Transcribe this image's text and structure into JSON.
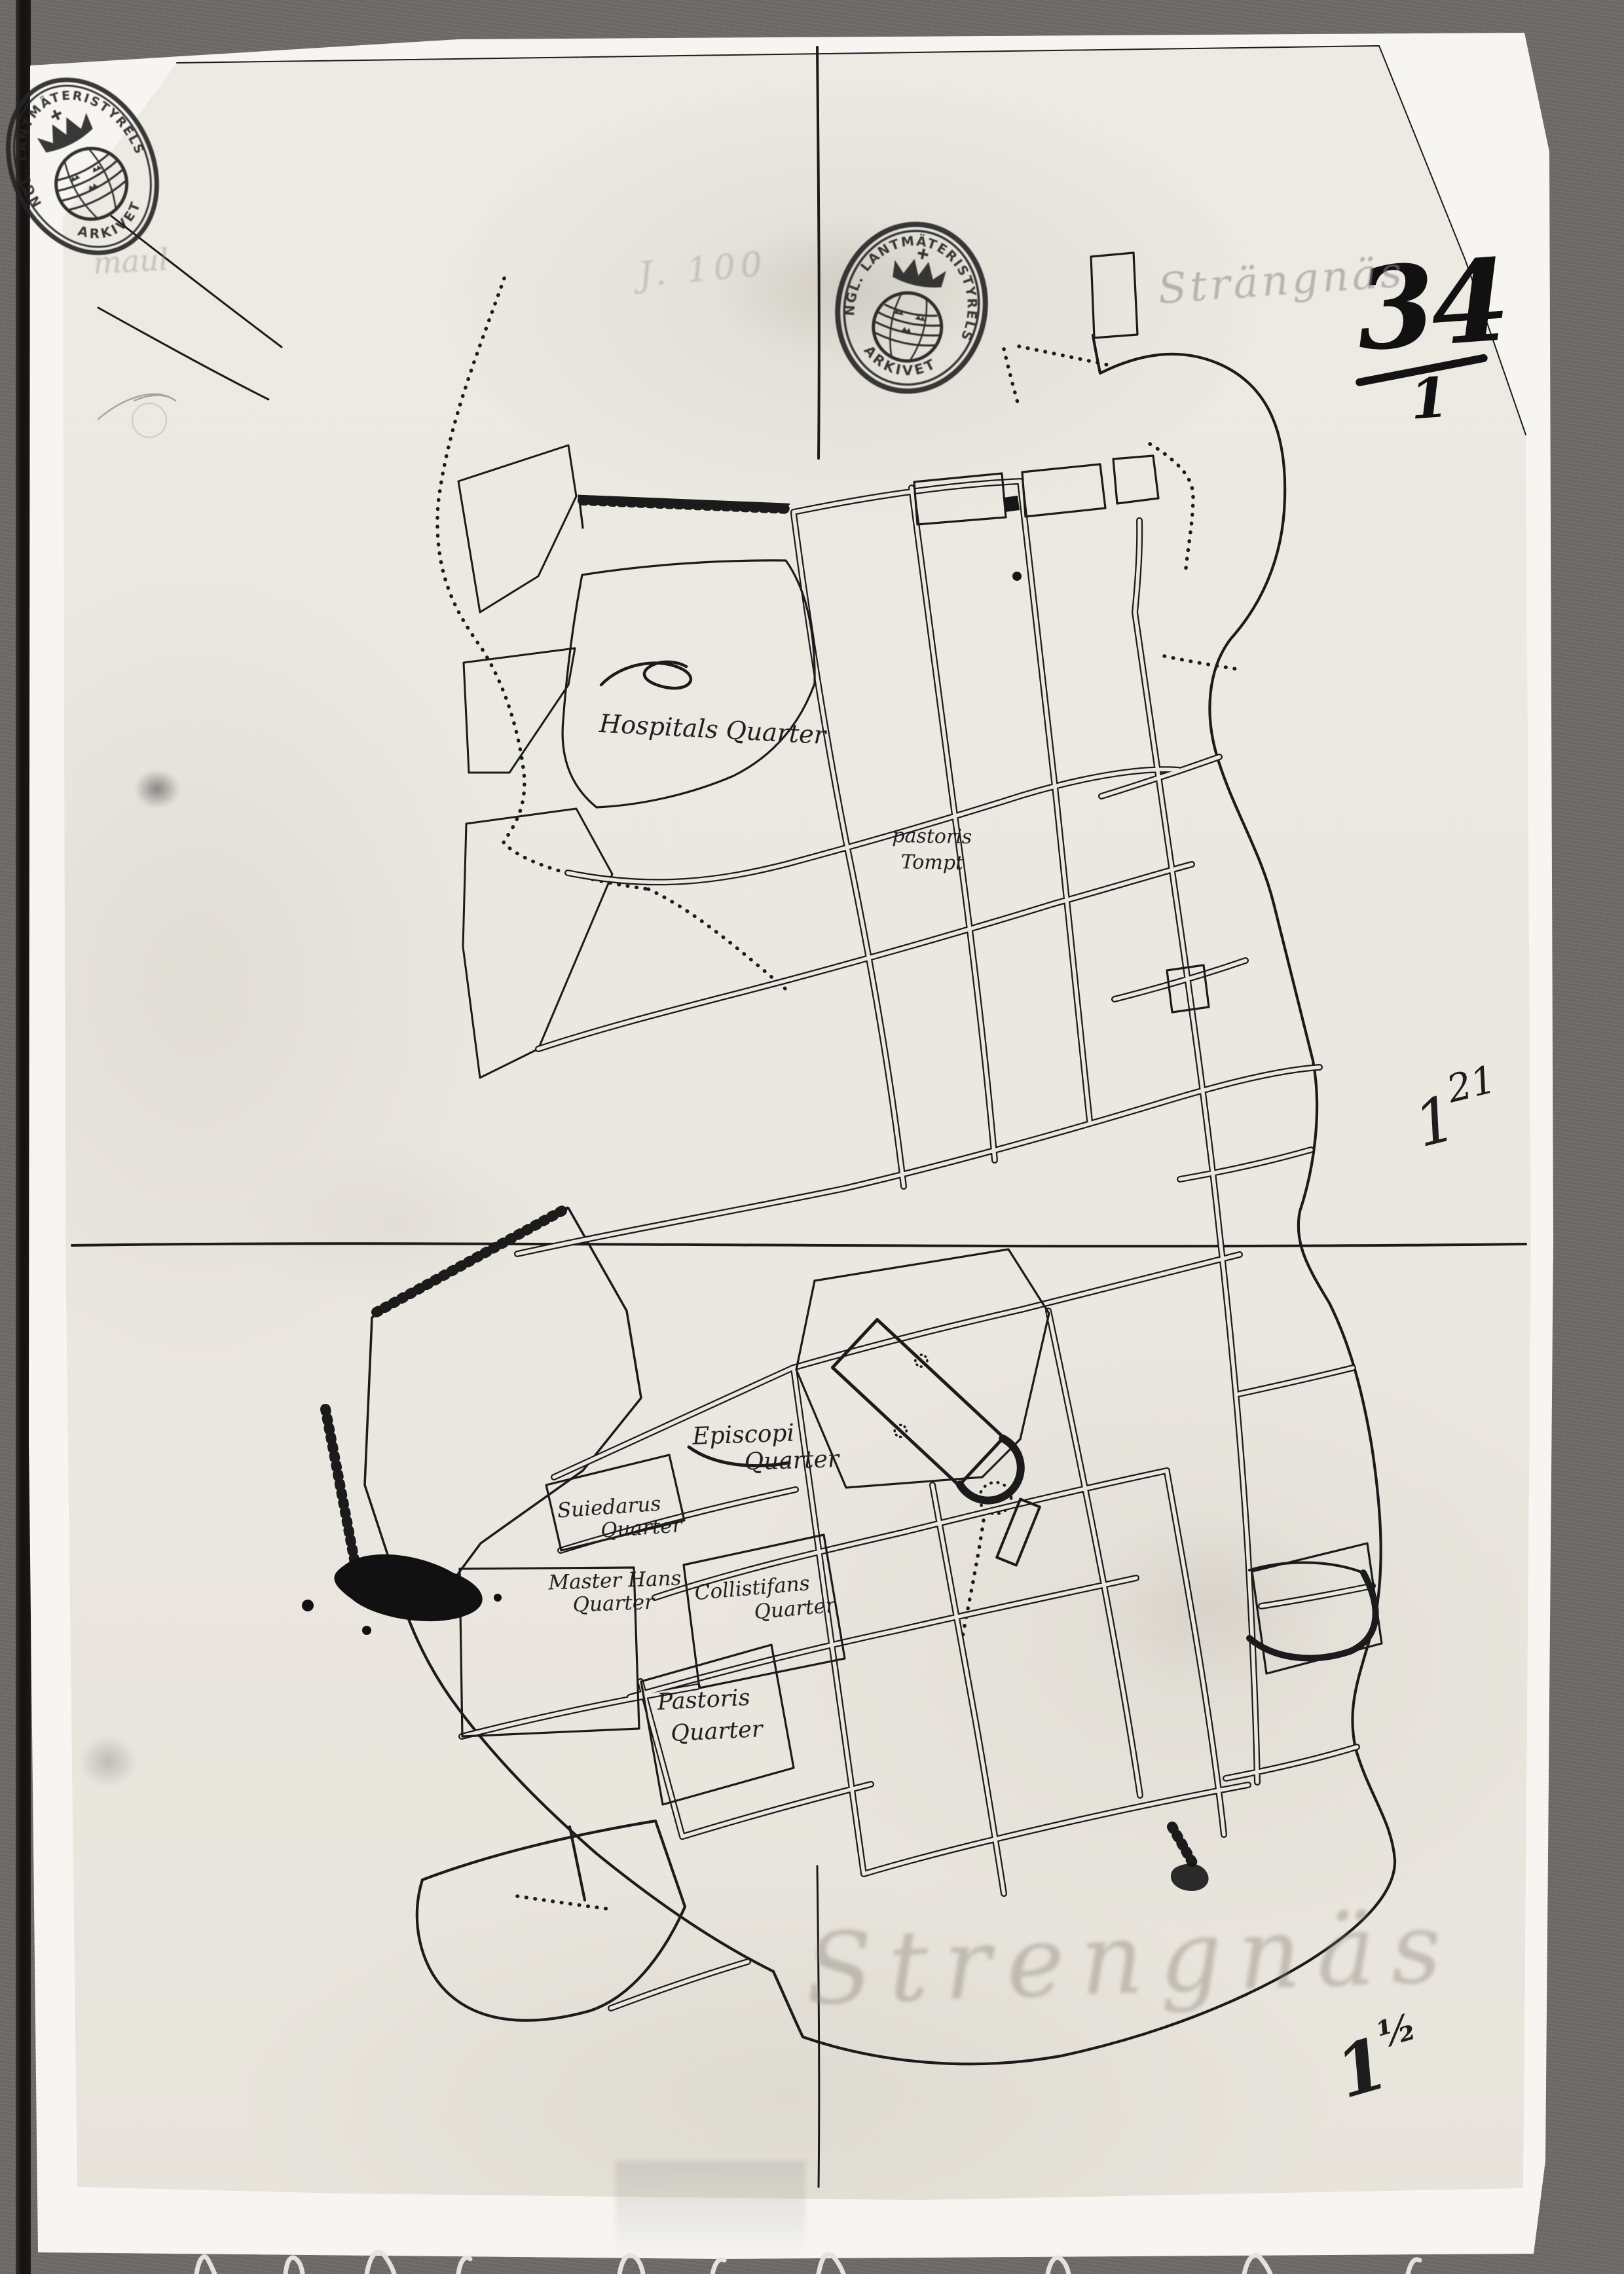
{
  "background_color": "#6c6a66",
  "paper": {
    "backing_color": "#f6f5f1",
    "map_sheet_color": "#ebe8e1",
    "ink_color": "#1b1b1b",
    "pencil_color": "#8b8b8b"
  },
  "stamps": {
    "corner": {
      "ring_text": "KUNGL. LANTMÄTERISTYRELSEN",
      "bottom_text": "ARKIVET"
    },
    "center": {
      "ring_text": "KUNGL. LANTMÄTERISTYRELSEN",
      "bottom_text": "ARKIVET"
    }
  },
  "annotations": {
    "sheet_number": {
      "numerator": "34",
      "denominator": "1"
    },
    "title_pencil": "Strängnäs",
    "note_left": "maul",
    "note_center": "J. 100",
    "folio_mark": {
      "digit": "1",
      "superscript": "21"
    },
    "bottom_mark": {
      "digit": "1",
      "superscript": "½"
    },
    "ghost_text": "Strengnäs"
  },
  "map_labels": {
    "hospitals": {
      "line1": "Hospitals Quarter",
      "line2": ""
    },
    "pastoris_tompt": {
      "line1": "pastoris",
      "line2": "Tompt"
    },
    "episcopi": {
      "line1": "Episcopi",
      "line2": "Quarter"
    },
    "suiedarus": {
      "line1": "Suiedarus",
      "line2": "Quarter"
    },
    "master_hans": {
      "line1": "Master Hans",
      "line2": "Quarter"
    },
    "collistifans": {
      "line1": "Collistifans",
      "line2": "Quarter"
    },
    "pastoris_quarter": {
      "line1": "Pastoris",
      "line2": "Quarter"
    }
  }
}
